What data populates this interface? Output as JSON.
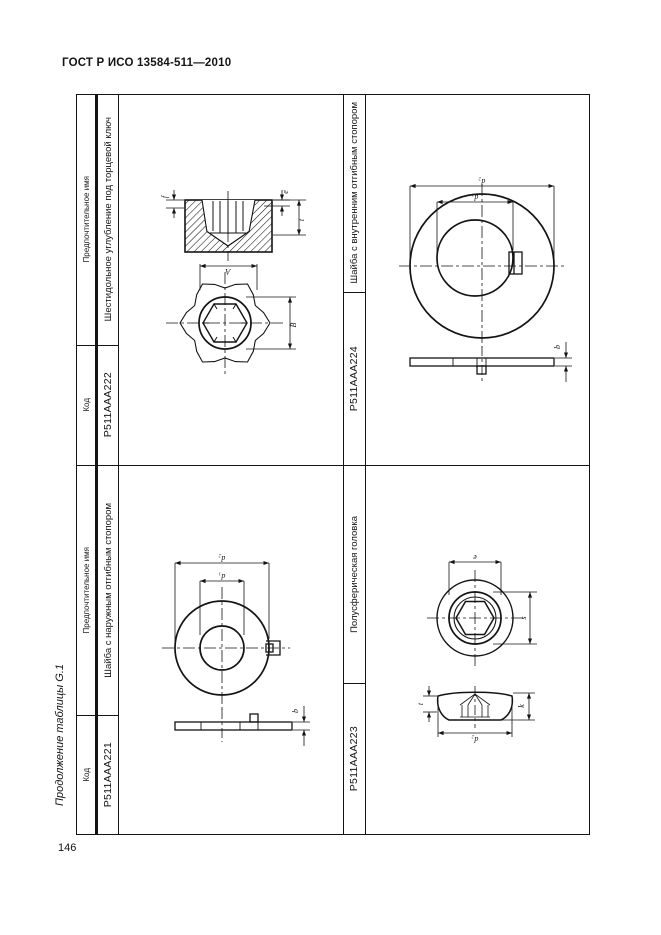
{
  "page": {
    "doc_header": "ГОСТ Р ИСО 13584-511—2010",
    "table_caption": "Продолжение таблицы G.1",
    "page_number": "146"
  },
  "table": {
    "headers": {
      "code": "Код",
      "name": "Предпочтительное имя"
    },
    "entries": {
      "e221": {
        "code": "P511AAA221",
        "name": "Шайба с наружным отгибным стопором"
      },
      "e222": {
        "code": "P511AAA222",
        "name": "Шестидольное углубление под торцевой ключ"
      },
      "e223": {
        "code": "P511AAA223",
        "name": "Полусферическая головка"
      },
      "e224": {
        "code": "P511AAA224",
        "name": "Шайба с внутренним отгибным стопором"
      }
    },
    "dims": {
      "knob": {
        "f": "f",
        "e_top": "е",
        "t": "t",
        "a": "A",
        "b": "B"
      },
      "washer_ext": {
        "d2": "d₂",
        "d1": "d₁",
        "b": "b"
      },
      "washer_int": {
        "d2": "d₂",
        "d1": "d₁",
        "b": "b"
      },
      "dome": {
        "e": "е",
        "s": "s",
        "t": "t",
        "k": "k",
        "d2": "d₂"
      }
    }
  }
}
